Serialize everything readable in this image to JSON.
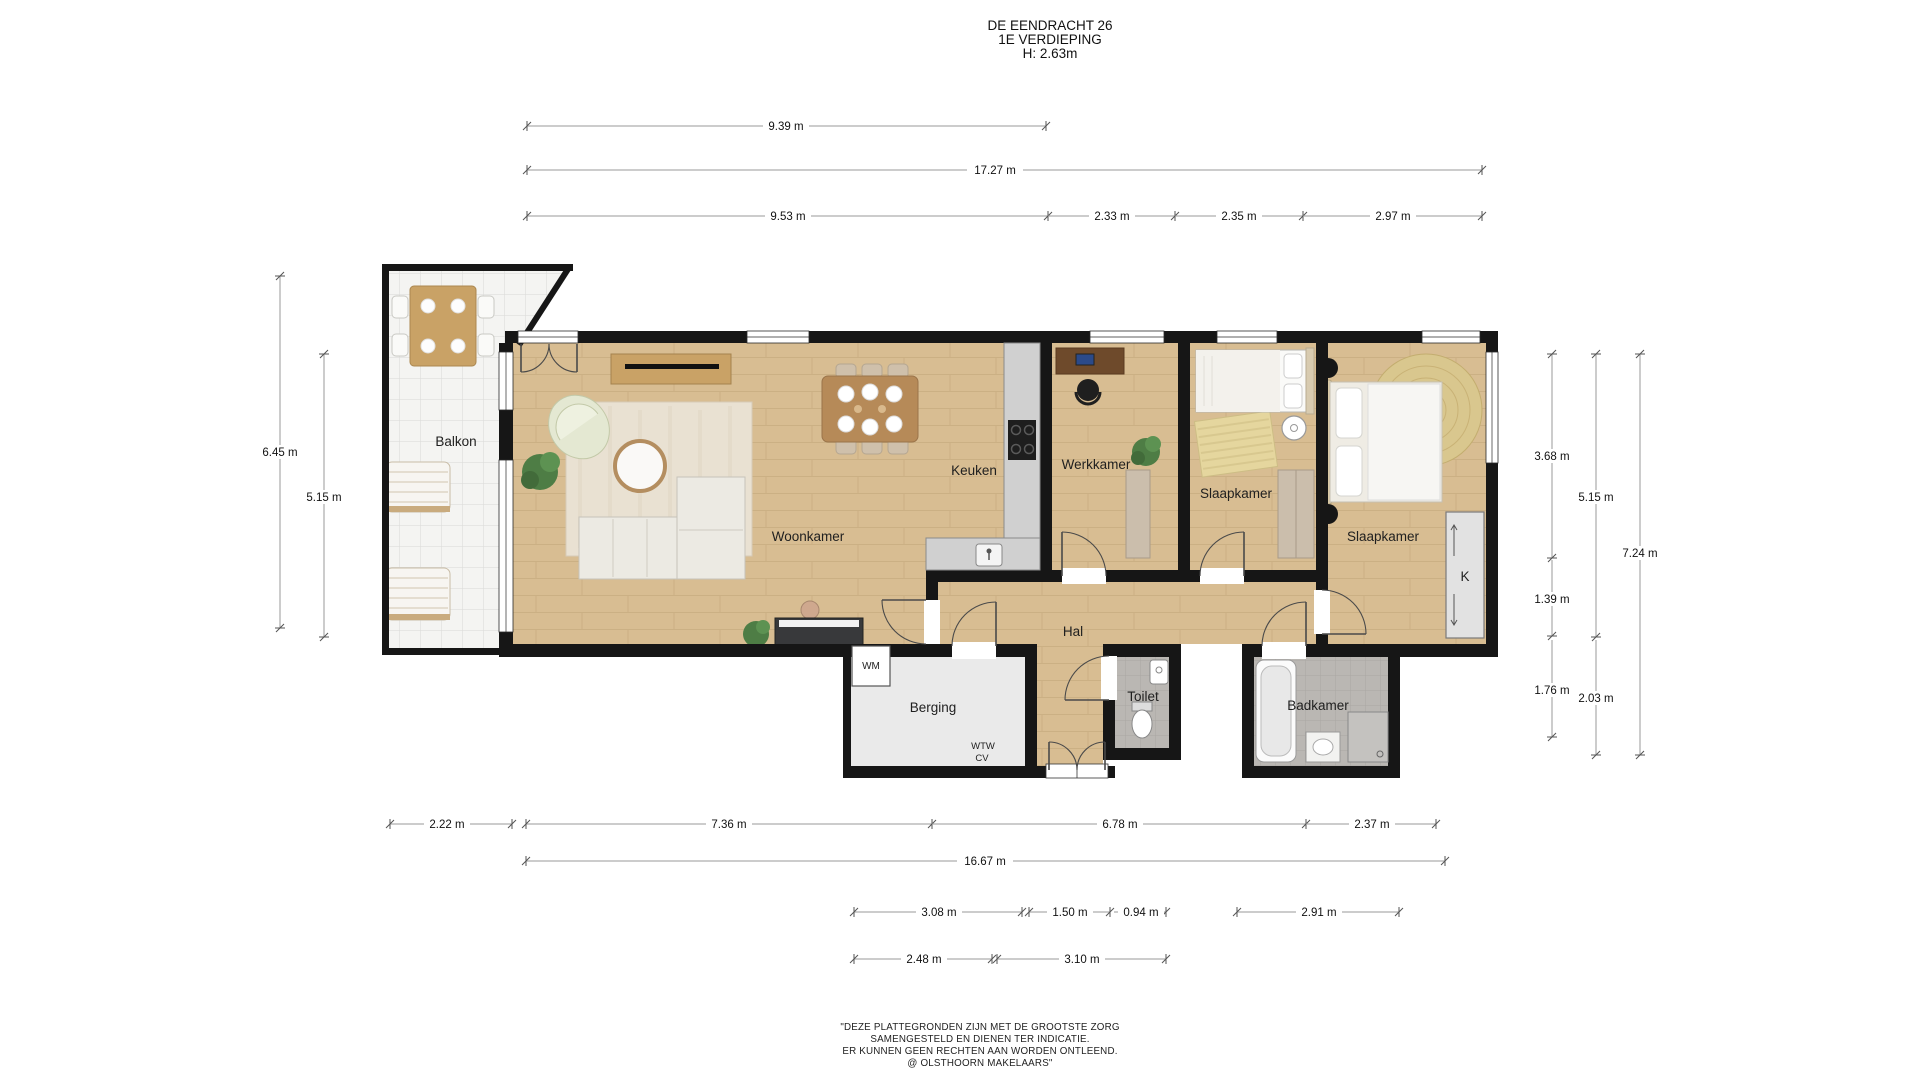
{
  "title": {
    "building": "DE EENDRACHT 26",
    "floor": "1E VERDIEPING",
    "ceiling_height": "H: 2.63m"
  },
  "rooms": {
    "balkon": "Balkon",
    "woonkamer": "Woonkamer",
    "keuken": "Keuken",
    "werkkamer": "Werkkamer",
    "slaapkamer_1": "Slaapkamer",
    "slaapkamer_2": "Slaapkamer",
    "hal": "Hal",
    "berging": "Berging",
    "toilet": "Toilet",
    "badkamer": "Badkamer",
    "kast": "K",
    "wasmachine": "WM",
    "wtw": "WTW",
    "cv": "CV"
  },
  "dimensions": {
    "top": [
      "9.39 m",
      "17.27 m",
      "9.53 m",
      "2.33 m",
      "2.35 m",
      "2.97 m"
    ],
    "left": [
      "6.45 m",
      "5.15 m"
    ],
    "right": [
      "3.68 m",
      "5.15 m",
      "7.24 m",
      "1.39 m",
      "1.76 m",
      "2.03 m"
    ],
    "bottom": [
      "2.22 m",
      "7.36 m",
      "6.78 m",
      "2.37 m",
      "16.67 m",
      "3.08 m",
      "1.50 m",
      "0.94 m",
      "2.91 m",
      "2.48 m",
      "3.10 m"
    ]
  },
  "footer": {
    "line1": "\"DEZE PLATTEGRONDEN ZIJN MET DE GROOTSTE ZORG",
    "line2": "SAMENGESTELD EN DIENEN TER INDICATIE.",
    "line3": "ER KUNNEN GEEN RECHTEN AAN WORDEN ONTLEEND.",
    "line4": "@ OLSTHOORN MAKELAARS\""
  },
  "colors": {
    "wall": "#161616",
    "wood_floor": "#d8bd92",
    "tile_floor": "#bab7b3",
    "storage_floor": "#eaeaea",
    "balcony_floor": "#f4f4f2",
    "counter": "#d0d0d0",
    "accent_wood": "#c9a266",
    "dimension_line": "#9a9a9a"
  }
}
